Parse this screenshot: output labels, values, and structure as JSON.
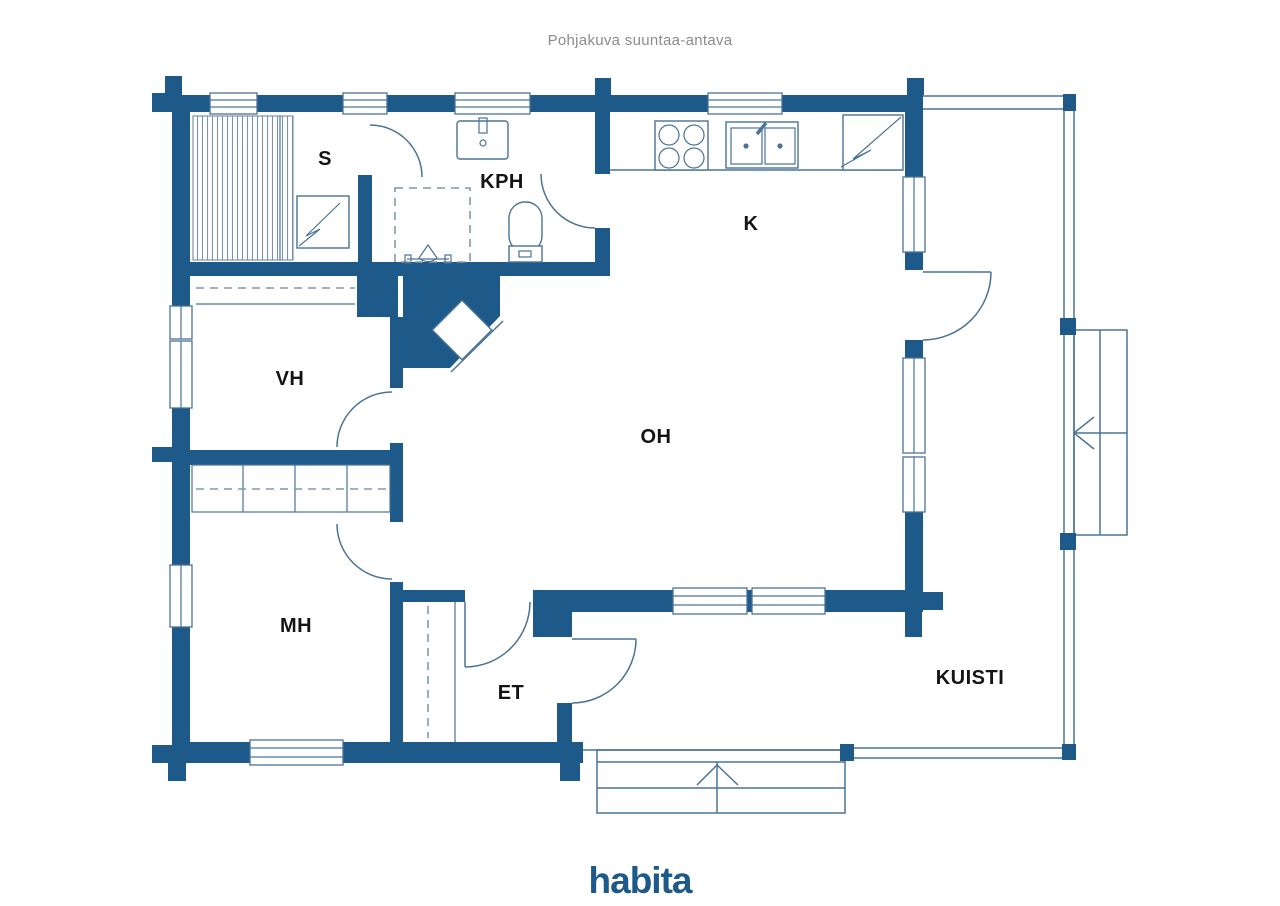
{
  "title": "Pohjakuva suuntaa-antava",
  "brand": {
    "logo_text": "habita"
  },
  "rooms": [
    {
      "id": "s",
      "label": "S",
      "name": "sauna"
    },
    {
      "id": "kph",
      "label": "KPH",
      "name": "bathroom"
    },
    {
      "id": "k",
      "label": "K",
      "name": "kitchen"
    },
    {
      "id": "vh",
      "label": "VH",
      "name": "walk-in-closet"
    },
    {
      "id": "oh",
      "label": "OH",
      "name": "living-room"
    },
    {
      "id": "mh",
      "label": "MH",
      "name": "bedroom"
    },
    {
      "id": "et",
      "label": "ET",
      "name": "entrance-hall"
    },
    {
      "id": "kuisti",
      "label": "KUISTI",
      "name": "porch"
    }
  ],
  "fixtures": [
    "sauna-bench-hatch",
    "sauna-heater-icon",
    "bathroom-sink-icon",
    "shower-icon",
    "toilet-icon",
    "stove-burners-icon",
    "kitchen-sink-icon",
    "fridge-icon",
    "fireplace",
    "entrance-steps-icon",
    "exterior-stairs-icon",
    "door-swing-arcs",
    "window-symbols",
    "porch-railing"
  ],
  "colors": {
    "wall": "#1d5a8a",
    "line": "#4a7396",
    "dash": "#8099ad",
    "label": "#141414",
    "title": "#8c8c8c",
    "logo": "#1d5a8a"
  }
}
